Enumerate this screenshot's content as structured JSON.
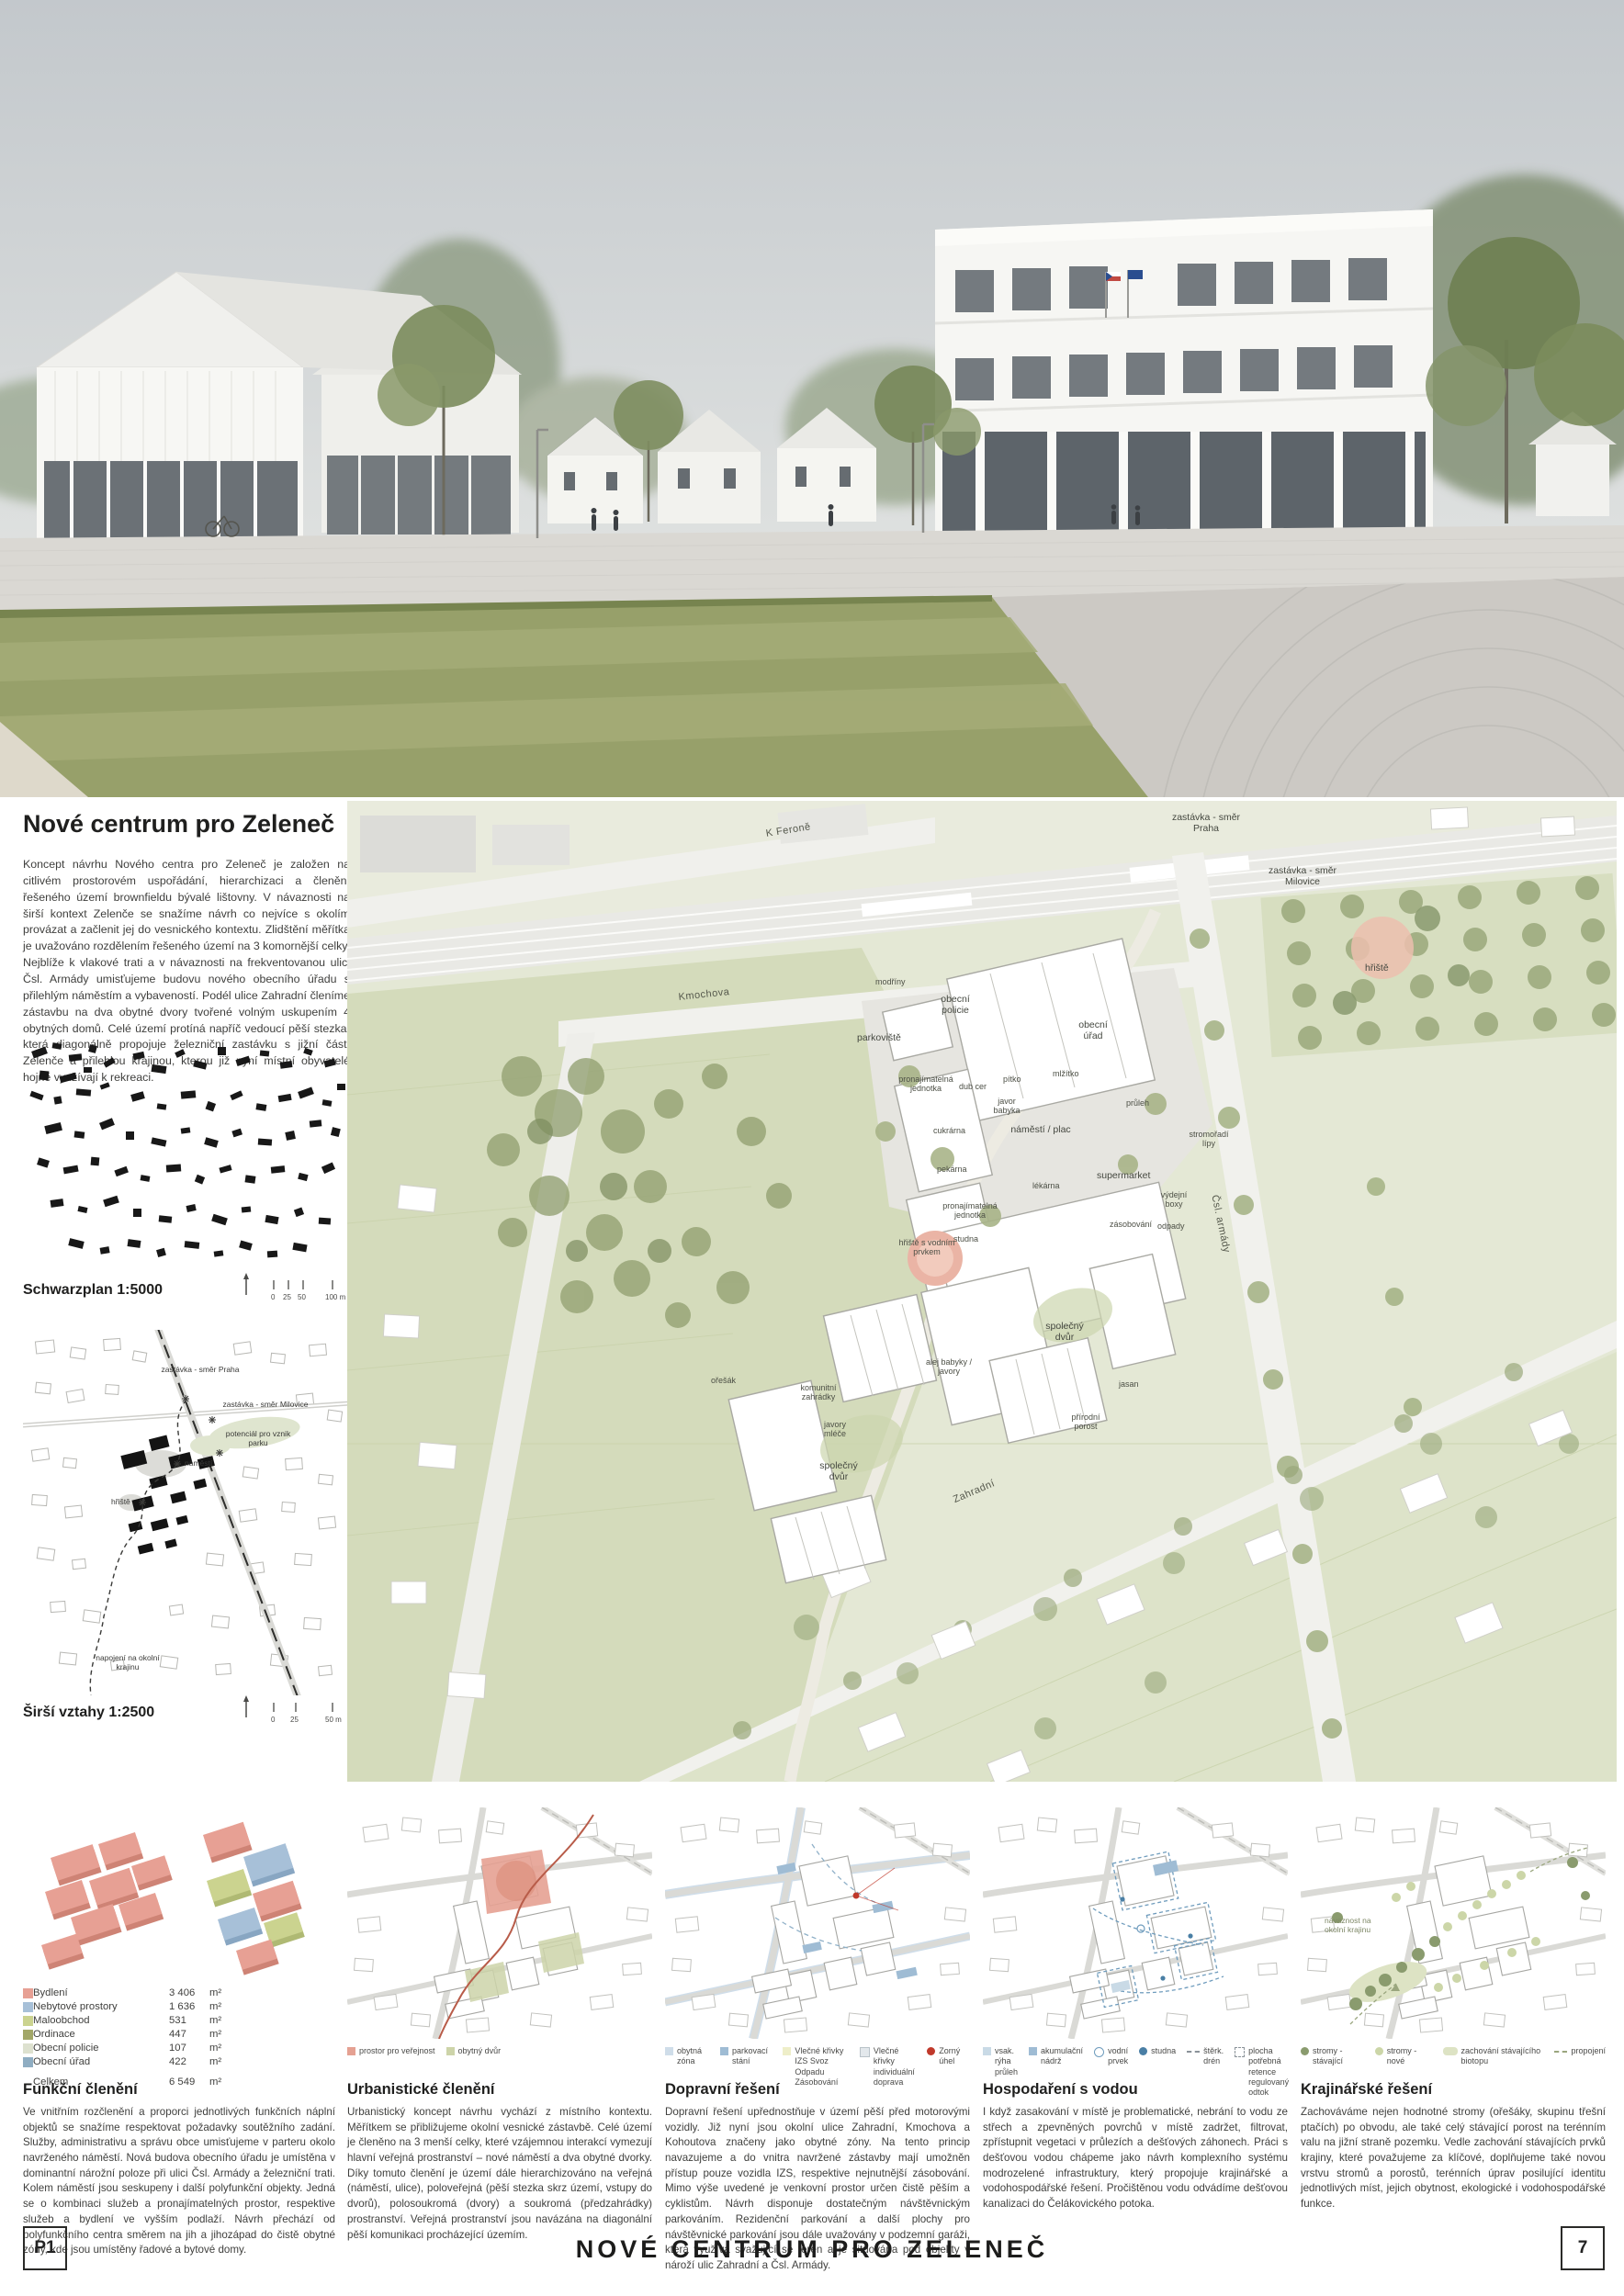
{
  "intro": {
    "title": "Nové centrum pro Zeleneč",
    "body": "Koncept návrhu Nového centra pro Zeleneč je založen na citlivém prostorovém uspořádání, hierarchizaci a členění řešeného území brownfieldu bývalé lištovny. V návaznosti na širší kontext Zelenče se snažíme návrh co nejvíce s okolím provázat a začlenit jej do vesnického kontextu. Zlidštění měřítka je uvažováno rozdělením řešeného území na 3 komornější celky. Nejblíže k vlakové trati a v návaznosti na frekventovanou ulici Čsl. Armády umisťujeme budovu nového obecního úřadu s přilehlým náměstím a vybaveností. Podél ulice Zahradní členíme zástavbu na dva obytné dvory tvořené volným uskupením 4 obytných domů. Celé území protíná napříč vedoucí pěší stezka, která diagonálně propojuje železniční zastávku s jižní částí Zelenče a přilehlou krajinou, kterou již nyní místní obyvatelé hojně využívají k rekreaci."
  },
  "figures": {
    "schwarzplan": {
      "caption": "Schwarzplan 1:5000",
      "scale_ticks": "0  25  50",
      "scale_end": "100  m"
    },
    "sirsi": {
      "caption": "Širší vztahy 1:2500",
      "scale_ticks": "0  25",
      "scale_end": "50  m",
      "labels": [
        "zastávka - směr Praha",
        "zastávka - směr Milovice",
        "potenciál pro vznik parku",
        "náměstí",
        "hřiště",
        "napojení na okolní krajinu"
      ]
    }
  },
  "funkcni": {
    "heading": "Funkční členění",
    "unit": "m²",
    "legend": [
      {
        "label": "Bydlení",
        "value": "3 406",
        "color": "#E7A094"
      },
      {
        "label": "Nebytové prostory",
        "value": "1 636",
        "color": "#A7C0D8"
      },
      {
        "label": "Maloobchod",
        "value": "531",
        "color": "#CBD38F"
      },
      {
        "label": "Ordinace",
        "value": "447",
        "color": "#A2A768"
      },
      {
        "label": "Obecní policie",
        "value": "107",
        "color": "#DDE1CF"
      },
      {
        "label": "Obecní úřad",
        "value": "422",
        "color": "#8FADC2"
      }
    ],
    "total": {
      "label": "Celkem",
      "value": "6 549"
    },
    "body": "Ve vnitřním rozčlenění a proporci jednotlivých funkčních náplní objektů se snažíme respektovat požadavky soutěžního zadání. Služby, administrativu a správu obce umisťujeme v parteru okolo navrženého náměstí. Nová budova obecního úřadu je umístěna v dominantní nárožní poloze při ulici Čsl. Armády a železniční trati. Kolem náměstí jsou seskupeny i další polyfunkční objekty. Jedná se o kombinaci služeb a pronajímatelných prostor, respektive služeb a bydlení ve vyšším podlaží. Návrh přechází od polyfunkčního centra směrem na jih a jihozápad do čistě obytné zóny, kde jsou umístěny řadové a bytové domy."
  },
  "sections": [
    {
      "heading": "Urbanistické členění",
      "legend": [
        "prostor pro veřejnost",
        "obytný dvůr"
      ],
      "body": "Urbanistický koncept návrhu vychází z místního kontextu. Měřítkem se přibližujeme okolní vesnické zástavbě. Celé území je členěno na 3 menší celky, které vzájemnou interakcí vymezují hlavní veřejná prostranství – nové náměstí a dva obytné dvorky. Díky tomuto členění je území dále hierarchizováno na veřejná (náměstí, ulice), poloveřejná (pěší stezka skrz území, vstupy do dvorů), polosoukromá (dvory) a soukromá (předzahrádky) prostranství. Veřejná prostranství jsou navázána na diagonální pěší komunikaci procházející územím."
    },
    {
      "heading": "Dopravní řešení",
      "legend": [
        "obytná zóna",
        "parkovací stání",
        "Vlečné křivky IZS Svoz Odpadu Zásobování",
        "Vlečné křivky individuální doprava",
        "Zorný úhel"
      ],
      "body": "Dopravní řešení upřednostňuje v území pěší před motorovými vozidly. Již nyní jsou okolní ulice Zahradní, Kmochova a Kohoutova značeny jako obytné zóny. Na tento princip navazujeme a do vnitra navržené zástavby mají umožněn přístup pouze vozidla IZS, respektive nejnutnější zásobování. Mimo výše uvedené je venkovní prostor určen čistě pěším a cyklistům. Návrh disponuje dostatečným návštěvnickým parkováním. Rezidenční parkování a další plochy pro návštěvnické parkování jsou dále uvažovány v podzemní garáži, která využívá svažující se terén a je situována pod objekty v nároží ulic Zahradní a Čsl. Armády."
    },
    {
      "heading": "Hospodaření s vodou",
      "legend": [
        "vsak. rýha průleh",
        "akumulační nádrž",
        "vodní prvek",
        "studna",
        "štěrk. drén",
        "plocha potřebná retence regulovaný odtok"
      ],
      "body": "I když zasakování v místě je problematické, nebrání to vodu ze střech a zpevněných povrchů v místě zadržet, filtrovat, zpřístupnit vegetaci v průlezích a dešťových záhonech. Práci s dešťovou vodou chápeme jako návrh komplexního systému modrozelené infrastruktury, který propojuje krajinářské a vodohospodářské řešení. Pročištěnou vodu odvádíme dešťovou kanalizaci do Čelákovického potoka."
    },
    {
      "heading": "Krajinářské řešení",
      "legend": [
        "stromy - stávající",
        "stromy - nové",
        "zachování stávajícího biotopu",
        "propojení"
      ],
      "note": "návaznost na okolní krajinu",
      "body": "Zachováváme nejen hodnotné stromy (ořešáky, skupinu třešní ptačích) po obvodu, ale také celý stávající porost na terénním valu na jižní straně pozemku. Vedle zachování stávajících prvků krajiny, které považujeme za klíčové, doplňujeme také novou vrstvu stromů a porostů, terénních úprav posilující identitu jednotlivých míst, jejich obytnost, ekologické i vodohospodářské funkce."
    }
  ],
  "site_plan": {
    "labels": [
      "K Feroně",
      "zastávka - směr Praha",
      "zastávka - směr Milovice",
      "Kmochova",
      "modříny",
      "parkoviště",
      "obecní policie",
      "obecní úřad",
      "pítko",
      "mlžítko",
      "náměstí / plac",
      "dub cer",
      "javor babyka",
      "průleh",
      "supermarket",
      "lékárna",
      "cukrárna",
      "pekárna",
      "pronajímatelná jednotka",
      "pronajímatelná jednotka",
      "zásobování",
      "odpady",
      "výdejní boxy",
      "stromořadí lípy",
      "Čsl. armády",
      "Zahradní",
      "hřiště s vodním prvkem",
      "studna",
      "společný dvůr",
      "společný dvůr",
      "komunitní zahrádky",
      "javory mléče",
      "ořešák",
      "alej babyky / javory",
      "přírodní porost",
      "jasan",
      "hřiště"
    ]
  },
  "colors": {
    "bydleni": "#E7A094",
    "nebytove_prostory": "#A7C0D8",
    "maloobchod": "#CBD38F",
    "ordinace": "#A2A768",
    "obecni_policie": "#DDE1CF",
    "obecni_urad": "#8FADC2",
    "prostor_pro_verejnost": "#E5A192",
    "obytny_dvur": "#CDD4A9",
    "obytna_zona": "#CFDDE9",
    "parkovaci_stani": "#9FBCD4",
    "vlecne_krivky_izs": "#EEEEC9",
    "vlecne_krivky_individualni": "#E3E8EC",
    "zorny_uhel": "#C0392B",
    "vsak_ryha": "#C9DAE6",
    "akumulacni_nadrz": "#9FBCD4",
    "studna": "#4A7FA5",
    "stromy_stavajici": "#8A9B6E",
    "stromy_nove": "#CCD6A8",
    "biotop": "#DDE3C4"
  },
  "footer": {
    "panel_code": "P1",
    "title": "NOVÉ CENTRUM PRO ZELENEČ",
    "page_number": "7"
  }
}
